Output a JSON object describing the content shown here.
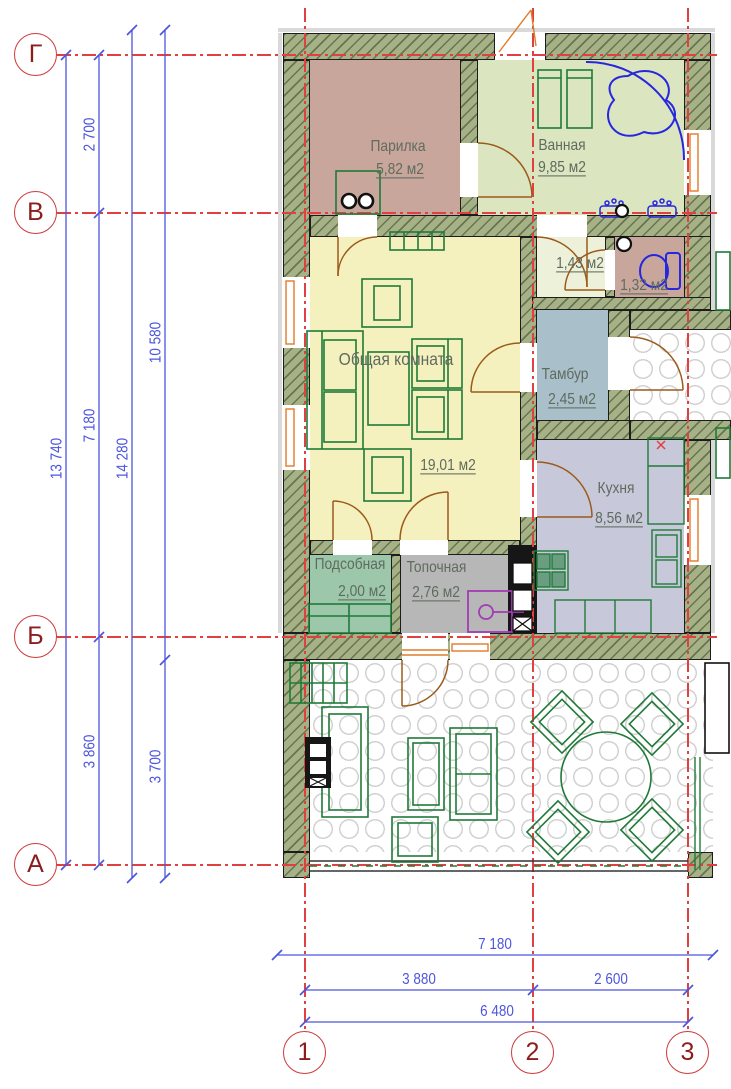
{
  "drawing": "house floor plan",
  "axes": {
    "rows": [
      "Г",
      "В",
      "Б",
      "А"
    ],
    "cols": [
      "1",
      "2",
      "3"
    ]
  },
  "dims": {
    "left": {
      "total": "13 740",
      "seg_top": "2 700",
      "seg_mid": "7 180",
      "seg_bot": "3 860",
      "overall": "14 280",
      "upper": "10 580",
      "lower": "3 700"
    },
    "bottom": {
      "overall": "7 180",
      "seg_left": "3 880",
      "seg_right": "2 600",
      "axes_total": "6 480"
    }
  },
  "rooms": {
    "parilka": {
      "name": "Парилка",
      "area": "5,82 м2"
    },
    "vannaya": {
      "name": "Ванная",
      "area": "9,85 м2"
    },
    "wc_lobby": {
      "name": "",
      "area": "1,43 м2"
    },
    "wc": {
      "name": "",
      "area": "1,32 м2"
    },
    "obshchaya": {
      "name": "Общая комната",
      "area": "19,01 м2"
    },
    "tambur": {
      "name": "Тамбур",
      "area": "2,45 м2"
    },
    "kuhnya": {
      "name": "Кухня",
      "area": "8,56 м2"
    },
    "podsobnaya": {
      "name": "Подсобная",
      "area": "2,00 м2"
    },
    "topochnaya": {
      "name": "Топочная",
      "area": "2,76 м2"
    }
  },
  "palette": {
    "wall": "#a6b286",
    "parilka": "#c8a69b",
    "bathroom": "#dbe5c0",
    "wc": "#c8a69b",
    "lobby": "#edf1da",
    "tambour": "#a9bfca",
    "living": "#f5f1bf",
    "utility": "#9dc7aa",
    "boiler_room": "#b7b7b7",
    "kitchen": "#c7c8d9",
    "axis_red": "#e04040",
    "dimension_blue": "#4d55dd",
    "furniture_green": "#1f7a38",
    "sanitary_blue": "#2727dd",
    "door_orange": "#a85c16",
    "window_orange": "#e07b28",
    "boiler_purple": "#a23bb5"
  }
}
